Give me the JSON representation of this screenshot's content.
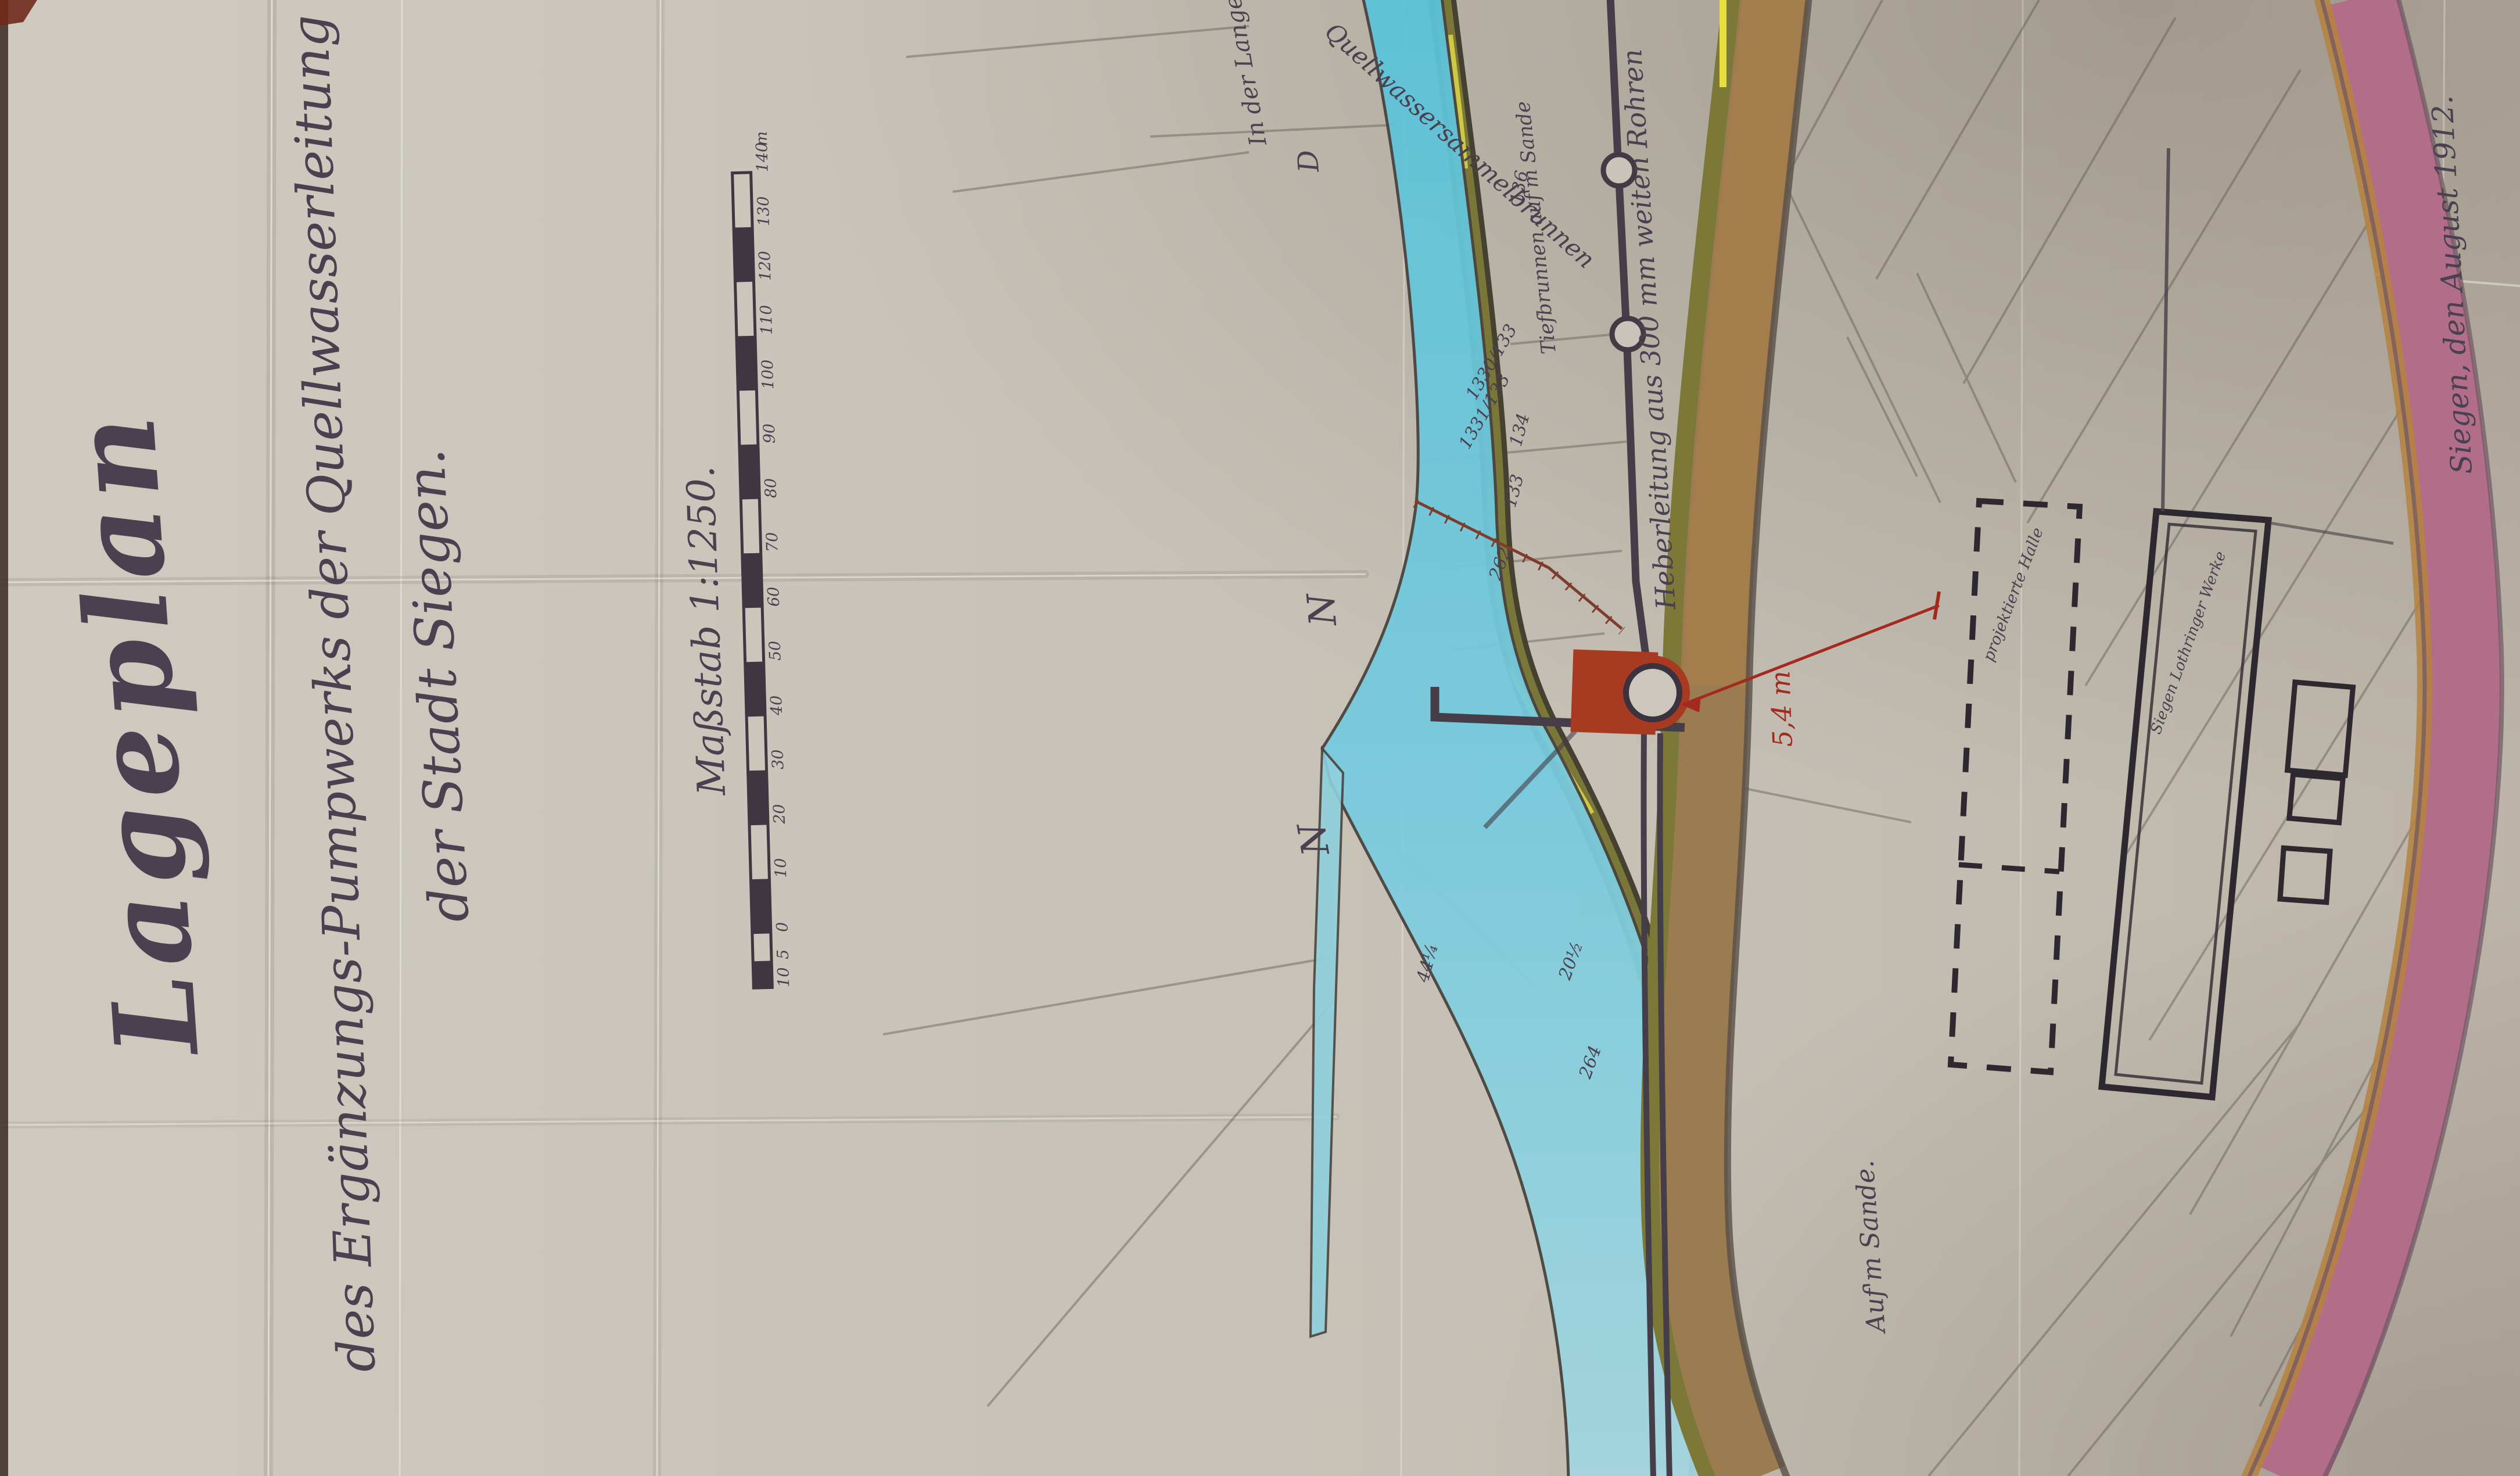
{
  "title_block": {
    "title": "Lageplan",
    "subtitle_line1": "des Ergänzungs-Pumpwerks der Quellwasserleitung",
    "subtitle_line2": "der Stadt Siegen.",
    "scale_label": "Maßstab 1:1250."
  },
  "date_note": "Siegen, den August 1912.",
  "scale_bar": {
    "unit": "m",
    "ticks": [
      "10",
      "5",
      "0",
      "10",
      "20",
      "30",
      "40",
      "50",
      "60",
      "70",
      "80",
      "90",
      "100",
      "110",
      "120",
      "130",
      "140",
      "m"
    ]
  },
  "annotations": {
    "projected_hall": "projektierte Halle",
    "works_parcel": "Siegen Lothringer Werke",
    "field_name_bottom": "Auf'm Sande.",
    "field_name_top": "In der Langenau",
    "wells_label": "Tiefbrunnen auf'm Sande",
    "pipeline_label": "Heberleitung aus 300 mm weiten Rohren",
    "collector_label": "Quellwassersammelbrunnen",
    "dimension_red": "5,4 m",
    "symbols": [
      "N",
      "N",
      "D"
    ]
  },
  "parcel_numbers": [
    "1330/133",
    "1331/133",
    "134",
    "133",
    "136",
    "262",
    "20½",
    "264",
    "44¼"
  ],
  "colors": {
    "paper": "#c7c1b7",
    "ink": "#4a4150",
    "stream_blue": "#6ac4d8",
    "bank_olive": "#77743a",
    "road_brown": "#9b7b50",
    "road_pink": "#b26e88",
    "road_edge_orange": "#b5823f",
    "building_red": "#a93a22",
    "red_ink": "#a52a1e"
  }
}
